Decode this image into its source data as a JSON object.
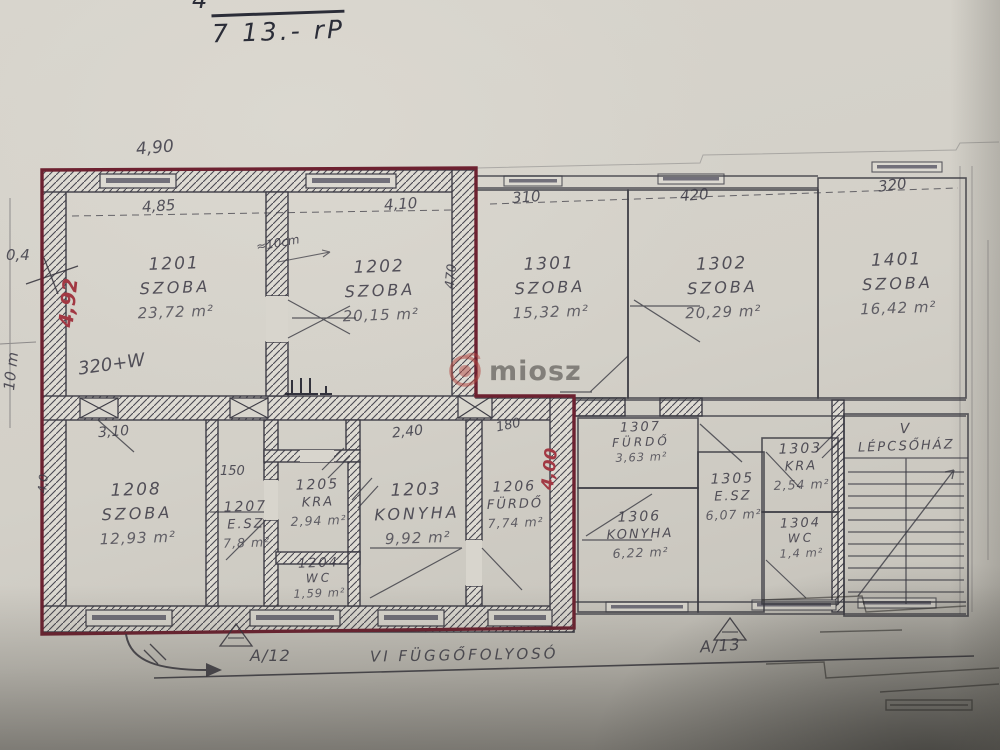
{
  "handwriting": {
    "top_note": "7 13.- rP",
    "top_partial": "4"
  },
  "watermark": {
    "text": "miosz"
  },
  "rooms": {
    "r1201": {
      "id": "1201",
      "name": "SZOBA",
      "area": "23,72 m²"
    },
    "r1202": {
      "id": "1202",
      "name": "SZOBA",
      "area": "20,15 m²"
    },
    "r1301": {
      "id": "1301",
      "name": "SZOBA",
      "area": "15,32 m²"
    },
    "r1302": {
      "id": "1302",
      "name": "SZOBA",
      "area": "20,29 m²"
    },
    "r1401": {
      "id": "1401",
      "name": "SZOBA",
      "area": "16,42 m²"
    },
    "r1208": {
      "id": "1208",
      "name": "SZOBA",
      "area": "12,93 m²"
    },
    "r1207": {
      "id": "1207",
      "name": "E.SZ",
      "area": "7,8 m²"
    },
    "r1205": {
      "id": "1205",
      "name": "KRA",
      "area": "2,94 m²"
    },
    "r1204": {
      "id": "1204",
      "name": "WC",
      "area": "1,59 m²"
    },
    "r1203": {
      "id": "1203",
      "name": "KONYHA",
      "area": "9,92 m²"
    },
    "r1206": {
      "id": "1206",
      "name": "FÜRDŐ",
      "area": "7,74 m²"
    },
    "r1307": {
      "id": "1307",
      "name": "FÜRDŐ",
      "area": "3,63 m²"
    },
    "r1306": {
      "id": "1306",
      "name": "KONYHA",
      "area": "6,22 m²"
    },
    "r1305": {
      "id": "1305",
      "name": "E.SZ",
      "area": "6,07 m²"
    },
    "r1303": {
      "id": "1303",
      "name": "KRA",
      "area": "2,54 m²"
    },
    "r1304": {
      "id": "1304",
      "name": "WC",
      "area": "1,4 m²"
    },
    "stair": {
      "id": "V",
      "name": "LÉPCSŐHÁZ"
    }
  },
  "dims": {
    "top_plan_width": "4,90",
    "w1201": "4,85",
    "w1202": "4,10",
    "h1202": "470",
    "wall_note": "≈10cm",
    "w1301": "310",
    "w1302": "420",
    "w1401": "320",
    "left_offset": "0,4",
    "left_total": "10 m",
    "red_left_height": "4,92",
    "red_mid_height": "4,00",
    "note_320w": "320+W",
    "w1208": "3,10",
    "h1208": "4,0",
    "w1207": "150",
    "w1203": "2,40",
    "w1206": "180"
  },
  "footer": {
    "left_unit": "A/12",
    "corridor": "VI FÜGGŐFOLYOSÓ",
    "right_unit": "A/13"
  },
  "colors": {
    "paper": "#d3d0c8",
    "pencil": "#45444c",
    "red_outline": "#6d2130",
    "red_text": "#a23843",
    "ink": "#2b2d38"
  }
}
